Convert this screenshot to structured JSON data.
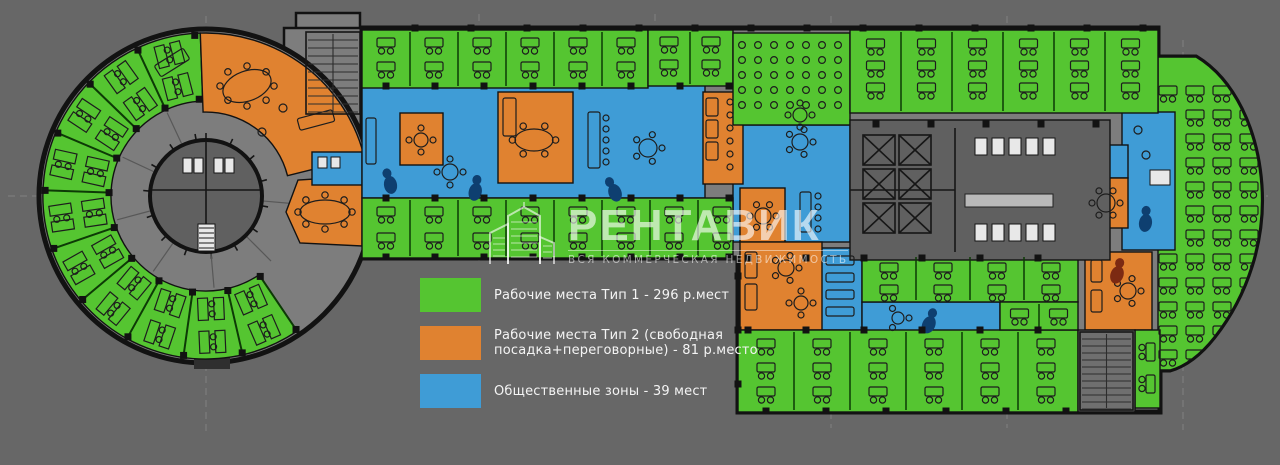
{
  "colors": {
    "background": "#676767",
    "floor": "#7d7d7d",
    "core_floor": "#606060",
    "wall": "#121212",
    "zone_green": "#55c531",
    "zone_orange": "#e08230",
    "zone_blue": "#3f9cd6",
    "partition_green": "#0d3a06",
    "furniture_line": "#1d1d1d",
    "accent_navy": "#0e3f70",
    "accent_maroon": "#7c2a12",
    "fixture_white": "#e8e8e8",
    "legend_text": "#f4f4f4"
  },
  "legend": {
    "items": [
      {
        "key": "workplaces_type1",
        "color_key": "zone_green",
        "label": "Рабочие места Тип 1 - 296 р.мест",
        "seats": 296
      },
      {
        "key": "workplaces_type2",
        "color_key": "zone_orange",
        "label": "Рабочие места Тип 2 (свободная посадка+переговорные) - 81 р.место",
        "seats": 81
      },
      {
        "key": "public_zones",
        "color_key": "zone_blue",
        "label": "Общественные зоны - 39 мест",
        "seats": 39
      }
    ]
  },
  "watermark": {
    "brand": "РЕНТАВИК",
    "tagline": "ВСЯ КОММЕРЧЕСКАЯ НЕДВИЖИМОСТЬ",
    "logo": "buildings-icon"
  },
  "plan": {
    "type": "office-floor-plan",
    "zones": [
      {
        "name": "Рабочие места Тип 1",
        "seats": 296,
        "color_key": "zone_green"
      },
      {
        "name": "Рабочие места Тип 2 (свободная посадка+переговорные)",
        "seats": 81,
        "color_key": "zone_orange"
      },
      {
        "name": "Общественные зоны",
        "seats": 39,
        "color_key": "zone_blue"
      }
    ]
  }
}
